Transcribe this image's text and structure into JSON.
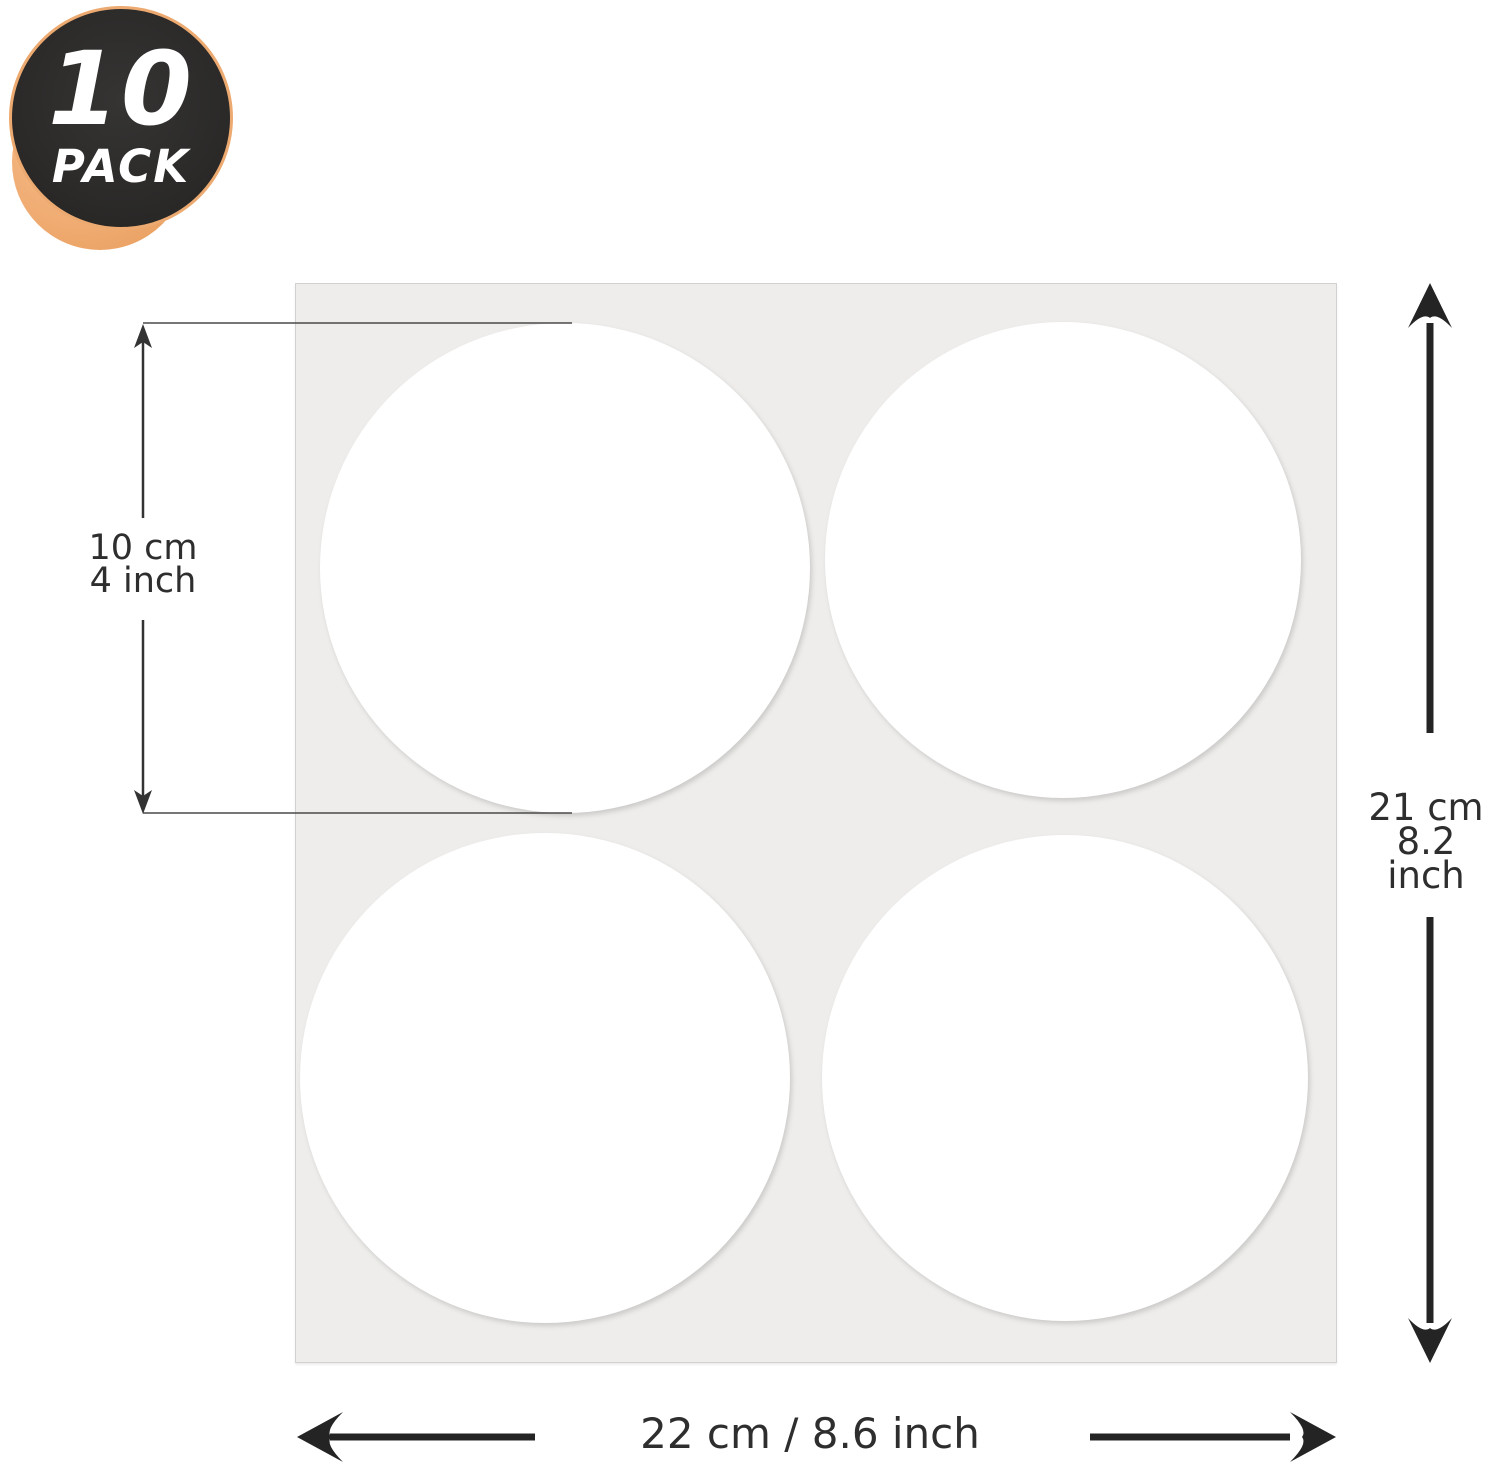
{
  "badge": {
    "count": "10",
    "label": "PACK"
  },
  "sheet": {
    "rows": 2,
    "cols": 2,
    "visible_circles": 4
  },
  "annotations": {
    "circle_size": {
      "line1": "10 cm",
      "line2": "4 inch"
    },
    "sheet_height": {
      "line1": "21 cm",
      "line2": "8.2 inch"
    },
    "sheet_width": {
      "label": "22 cm / 8.6 inch"
    }
  },
  "colors": {
    "background": "#ffffff",
    "badge_bg": "#2b2a29",
    "badge_ring": "#edaa70",
    "badge_accent": "#f0ad74",
    "badge_text": "#ffffff",
    "sheet_bg": "#eeedeb",
    "sticker": "#ffffff",
    "annotation_text": "#2e2e2e",
    "arrow": "#242424"
  }
}
